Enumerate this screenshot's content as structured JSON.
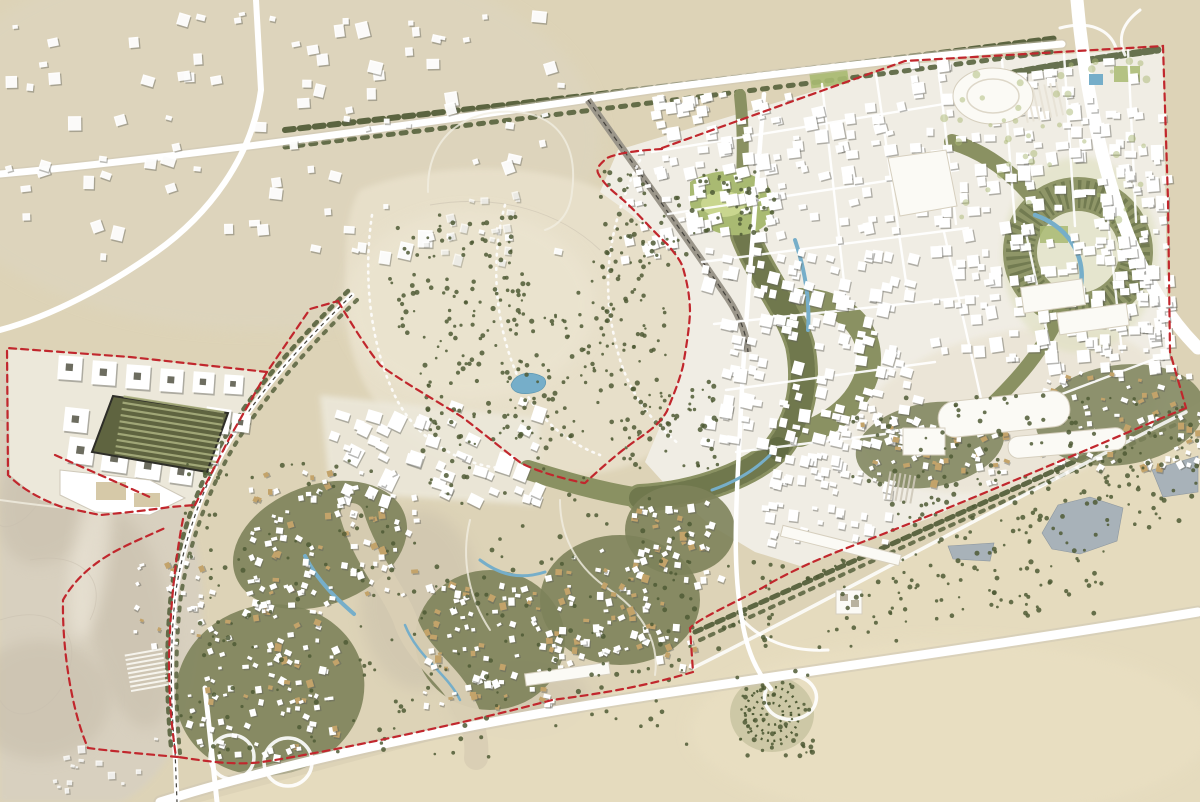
{
  "map": {
    "kind": "urban-masterplan-aerial-site-plan",
    "setting": "desert-city-development-with-dashed-site-boundary",
    "canvas": {
      "w": 1200,
      "h": 802
    }
  },
  "colors": {
    "desert-base": "#ddd3b7",
    "desert-tint-nw": "#ddd5c0",
    "desert-park": "#e8e0ca",
    "desert-park-light": "#ece5d1",
    "dune-sand": "#d8d0c0",
    "dune-shadow": "#c5bba8",
    "dune-light": "#efe9dc",
    "sand-se": "#e6dcbf",
    "road-white": "#ffffff",
    "road-casing": "#cdc6b4",
    "district-ground": "#f0ede4",
    "building-white": "#ffffff",
    "building-shadow": "#62625a",
    "building-tan": "#c3a36a",
    "veg-dark": "#4f5a35",
    "veg-mid": "#8a9162",
    "veg-olive": "#7d825a",
    "veg-light": "#aab873",
    "park-grass": "#a9ba72",
    "lawn-bright": "#c9d68f",
    "water-blue": "#76aec9",
    "water-gray": "#a8b2b9",
    "boundary-red": "#c1272d",
    "rail-dark": "#44423c",
    "path-sand": "#d9cfb4",
    "contour": "#c9bfae"
  },
  "site_boundary": {
    "stroke_width": 2.2,
    "dash": "7 5",
    "paths": {
      "perimeter_ne": "M662,148 L905,61 L1163,46 L1168,200 L1170,352 L1186,408",
      "perimeter_diag": "M1186,408 C1080,452 960,505 852,546 C810,562 782,576 762,588 C730,605 700,618 690,628 L693,672",
      "perimeter_south": "M693,672 C640,688 590,695 552,700 C470,722 330,752 262,762 C232,766 200,760 178,757",
      "perimeter_west": "M178,757 C145,754 110,751 88,748 C72,712 62,650 63,600 C76,577 95,563 112,553 C130,543 150,535 165,528",
      "rail_east_edge": "M195,505 L230,437 L267,372 L310,309 L338,301",
      "west_lobe": "M267,372 L130,357 L7,348 L8,475 C22,489 42,500 62,507 L100,515 C122,513 150,510 170,507 L195,505",
      "rail_south": "M183,519 C175,560 170,610 169,660 C169,700 172,730 176,757",
      "park_west": "M338,301 C352,325 366,347 380,365 C398,379 440,403 462,417 C478,429 506,452 521,463 C536,471 560,478 584,483",
      "park_east": "M662,149 C645,150 620,152 607,158 C600,164 596,168 598,173 C604,185 614,192 622,199 C634,209 646,224 668,245 C676,255 681,261 683,268 C687,282 690,297 690,313 C689,331 686,348 683,366 C679,382 673,396 667,411 C660,424 648,432 635,441 C618,453 600,469 585,483",
      "lobe_inner": "M55,455 L152,498"
    }
  },
  "water_features": {
    "lakes": [
      "M1042,533 L1058,505 L1090,497 L1123,508 L1117,541 L1080,554 L1052,549 Z",
      "M948,546 L994,543 L990,561 L953,559 Z",
      "M1152,470 L1198,456 L1198,492 L1163,497 Z",
      "M1100,436 L1126,432 L1124,446 L1102,448 Z"
    ],
    "pond_d": "M511,385 C515,373 530,370 543,377 C549,382 545,391 532,393 C520,395 512,392 511,385 Z",
    "pool_d": "M1089,74 L1103,74 L1103,85 L1089,85 Z",
    "streams": [
      {
        "d": "M305,556 C318,582 338,600 354,614",
        "w": 4
      },
      {
        "d": "M480,560 C500,575 520,580 545,572",
        "w": 3
      },
      {
        "d": "M405,625 C418,658 448,674 460,700",
        "w": 2.5
      },
      {
        "d": "M795,240 C805,270 810,300 808,330",
        "w": 4
      },
      {
        "d": "M1035,215 C1072,228 1090,262 1078,298",
        "w": 4.5
      },
      {
        "d": "M770,455 C755,470 735,482 712,490",
        "w": 3
      }
    ]
  },
  "generated": {
    "building_fields": [
      {
        "t": "exist",
        "x": 5,
        "y": 5,
        "w": 560,
        "h": 250,
        "n": 95,
        "s1": 5,
        "s2": 15,
        "rot": 0,
        "jit": 40,
        "op": 0.95
      },
      {
        "t": "exist",
        "x": 415,
        "y": 190,
        "w": 110,
        "h": 70,
        "n": 18,
        "s1": 4,
        "s2": 9,
        "rot": 0,
        "jit": 30,
        "op": 0.7
      },
      {
        "t": "exist",
        "x": 50,
        "y": 735,
        "w": 110,
        "h": 60,
        "n": 14,
        "s1": 3,
        "s2": 8,
        "rot": 0,
        "jit": 30,
        "op": 0.8
      },
      {
        "t": "city",
        "x": 648,
        "y": 88,
        "w": 250,
        "h": 150,
        "n": 120,
        "s1": 6,
        "s2": 13,
        "rot": -10,
        "jit": 10
      },
      {
        "t": "city",
        "x": 905,
        "y": 58,
        "w": 255,
        "h": 150,
        "n": 120,
        "s1": 6,
        "s2": 13,
        "rot": -4,
        "jit": 10
      },
      {
        "t": "city",
        "x": 700,
        "y": 245,
        "w": 215,
        "h": 200,
        "n": 150,
        "s1": 6,
        "s2": 13,
        "rot": 12,
        "jit": 10
      },
      {
        "t": "city",
        "x": 925,
        "y": 215,
        "w": 240,
        "h": 150,
        "n": 110,
        "s1": 6,
        "s2": 13,
        "rot": -6,
        "jit": 10
      },
      {
        "t": "city",
        "x": 760,
        "y": 445,
        "w": 140,
        "h": 95,
        "n": 55,
        "s1": 5,
        "s2": 10,
        "rot": 10,
        "jit": 10
      },
      {
        "t": "city",
        "x": 620,
        "y": 150,
        "w": 60,
        "h": 120,
        "n": 20,
        "s1": 5,
        "s2": 10,
        "rot": -10,
        "jit": 12
      },
      {
        "t": "city",
        "x": 1080,
        "y": 170,
        "w": 90,
        "h": 210,
        "n": 60,
        "s1": 5,
        "s2": 11,
        "rot": -3,
        "jit": 10
      },
      {
        "t": "swd",
        "x": 325,
        "y": 398,
        "w": 210,
        "h": 100,
        "n": 48,
        "s1": 7,
        "s2": 16,
        "rot": 22,
        "jit": 12
      },
      {
        "t": "vill",
        "x": 185,
        "y": 590,
        "w": 150,
        "h": 165,
        "n": 120,
        "s1": 3.5,
        "s2": 7,
        "rot": 0,
        "jit": 60,
        "tan": 0.22
      },
      {
        "t": "vill",
        "x": 245,
        "y": 470,
        "w": 170,
        "h": 125,
        "n": 100,
        "s1": 3.5,
        "s2": 7,
        "rot": 0,
        "jit": 60,
        "tan": 0.22
      },
      {
        "t": "vill",
        "x": 420,
        "y": 580,
        "w": 140,
        "h": 130,
        "n": 90,
        "s1": 3.5,
        "s2": 7,
        "rot": 0,
        "jit": 60,
        "tan": 0.25
      },
      {
        "t": "vill",
        "x": 545,
        "y": 545,
        "w": 150,
        "h": 120,
        "n": 90,
        "s1": 3.5,
        "s2": 7,
        "rot": 0,
        "jit": 60,
        "tan": 0.2
      },
      {
        "t": "vill",
        "x": 630,
        "y": 500,
        "w": 90,
        "h": 80,
        "n": 40,
        "s1": 3.5,
        "s2": 7,
        "rot": 0,
        "jit": 60,
        "tan": 0.2
      },
      {
        "t": "vill",
        "x": 855,
        "y": 405,
        "w": 150,
        "h": 80,
        "n": 70,
        "s1": 3.5,
        "s2": 7,
        "rot": 0,
        "jit": 60,
        "tan": 0.3
      },
      {
        "t": "vill",
        "x": 1040,
        "y": 370,
        "w": 160,
        "h": 95,
        "n": 80,
        "s1": 3.5,
        "s2": 7,
        "rot": 0,
        "jit": 60,
        "tan": 0.3
      },
      {
        "t": "vill",
        "x": 130,
        "y": 555,
        "w": 70,
        "h": 90,
        "n": 25,
        "s1": 3,
        "s2": 6,
        "rot": 0,
        "jit": 60,
        "tan": 0.15
      }
    ],
    "tree_fields": [
      {
        "x": 390,
        "y": 215,
        "w": 140,
        "h": 120,
        "n": 90
      },
      {
        "x": 500,
        "y": 290,
        "w": 170,
        "h": 150,
        "n": 110
      },
      {
        "x": 420,
        "y": 330,
        "w": 130,
        "h": 130,
        "n": 80
      },
      {
        "x": 600,
        "y": 170,
        "w": 90,
        "h": 100,
        "n": 50
      },
      {
        "x": 620,
        "y": 380,
        "w": 100,
        "h": 90,
        "n": 50
      },
      {
        "x": 650,
        "y": 560,
        "w": 260,
        "h": 90,
        "n": 60
      },
      {
        "x": 890,
        "y": 470,
        "w": 220,
        "h": 150,
        "n": 130
      },
      {
        "x": 1090,
        "y": 430,
        "w": 110,
        "h": 100,
        "n": 40
      },
      {
        "x": 180,
        "y": 460,
        "w": 520,
        "h": 300,
        "n": 220
      },
      {
        "x": 850,
        "y": 395,
        "w": 360,
        "h": 90,
        "n": 80
      },
      {
        "x": 690,
        "y": 170,
        "w": 85,
        "h": 65,
        "n": 40
      },
      {
        "x": 735,
        "y": 668,
        "w": 80,
        "h": 90,
        "n": 55
      },
      {
        "x": 935,
        "y": 60,
        "w": 230,
        "h": 160,
        "n": 45,
        "r1": 2,
        "r2": 4,
        "fill": "var(--veg-light)",
        "op": 0.5
      },
      {
        "x": 585,
        "y": 240,
        "w": 60,
        "h": 120,
        "n": 30
      }
    ],
    "hatch_fields": [
      {
        "x": 128,
        "y": 652,
        "n": 9,
        "len": 38,
        "gap": 4.5,
        "rot": -10,
        "stroke": "#fbfaf4",
        "w": 2,
        "op": 0.9
      },
      {
        "x": 118,
        "y": 404,
        "n": 10,
        "len": 102,
        "gap": 6.3,
        "rot": 9,
        "stroke": "#a8ae7d",
        "w": 2.2,
        "op": 0.9
      },
      {
        "x": 1022,
        "y": 82,
        "n": 7,
        "len": 34,
        "gap": 6,
        "rot": 78,
        "stroke": "#e8e3d6",
        "w": 2,
        "op": 0.9
      },
      {
        "x": 884,
        "y": 472,
        "n": 6,
        "len": 28,
        "gap": 5,
        "rot": 100,
        "stroke": "#cfc9ba",
        "w": 2,
        "op": 0.9
      }
    ],
    "courtyard_blocks": [
      {
        "x": 58,
        "y": 356,
        "s": 24,
        "rot": 4
      },
      {
        "x": 92,
        "y": 361,
        "s": 24,
        "rot": 4
      },
      {
        "x": 126,
        "y": 365,
        "s": 24,
        "rot": 4
      },
      {
        "x": 160,
        "y": 369,
        "s": 23,
        "rot": 4
      },
      {
        "x": 193,
        "y": 372,
        "s": 21,
        "rot": 4
      },
      {
        "x": 224,
        "y": 375,
        "s": 19,
        "rot": 4
      },
      {
        "x": 64,
        "y": 408,
        "s": 24,
        "rot": 6
      },
      {
        "x": 68,
        "y": 438,
        "s": 26,
        "rot": 8
      },
      {
        "x": 102,
        "y": 446,
        "s": 26,
        "rot": 8
      },
      {
        "x": 136,
        "y": 454,
        "s": 25,
        "rot": 8
      },
      {
        "x": 170,
        "y": 461,
        "s": 23,
        "rot": 8
      },
      {
        "x": 205,
        "y": 408,
        "s": 25,
        "rot": 8
      },
      {
        "x": 198,
        "y": 442,
        "s": 21,
        "rot": 8
      },
      {
        "x": 232,
        "y": 414,
        "s": 18,
        "rot": 8
      }
    ]
  }
}
